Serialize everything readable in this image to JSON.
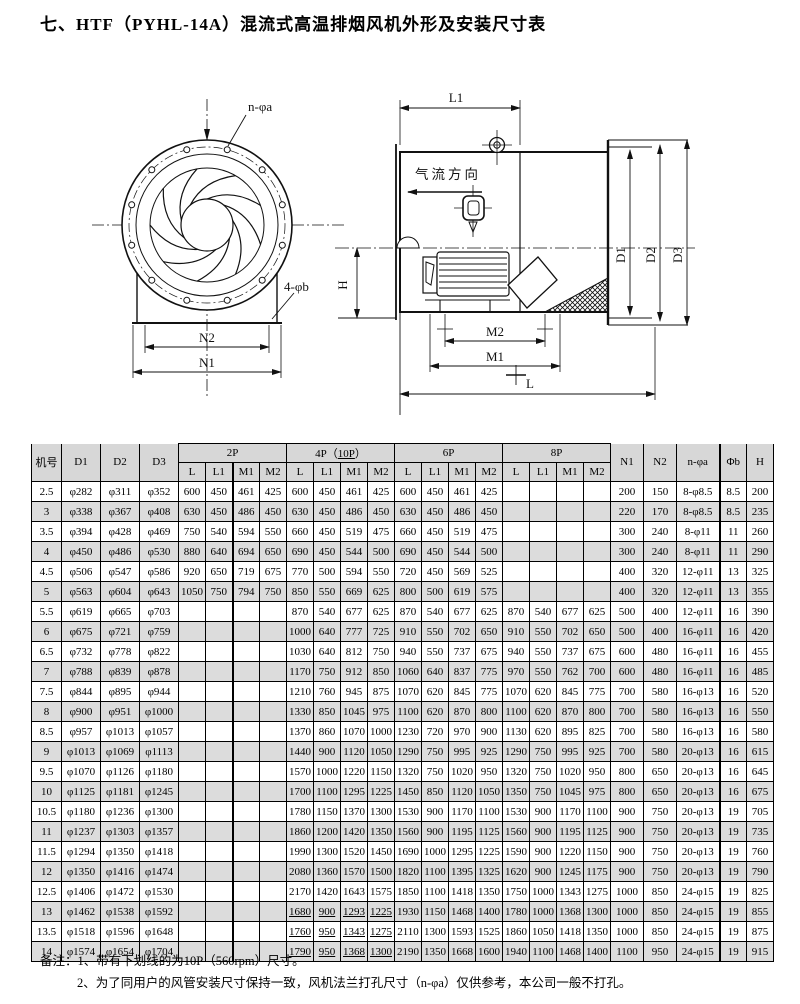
{
  "title": "七、HTF（PYHL-14A）混流式高温排烟风机外形及安装尺寸表",
  "front_view": {
    "label_bolt_holes": "n-φa",
    "label_base_holes": "4-φb",
    "label_n2": "N2",
    "label_n1": "N1"
  },
  "side_view": {
    "label_l1": "L1",
    "label_airflow": "气流方向",
    "label_d1": "D1",
    "label_d2": "D2",
    "label_d3": "D3",
    "label_h": "H",
    "label_m2": "M2",
    "label_m1": "M1",
    "label_l": "L"
  },
  "table": {
    "headers": {
      "jihao": "机号",
      "d1": "D1",
      "d2": "D2",
      "d3": "D3",
      "group_2p": "2P",
      "group_4p_pre": "4P（",
      "group_4p_u": "10P",
      "group_4p_post": "）",
      "group_6p": "6P",
      "group_8p": "8P",
      "sub": [
        "L",
        "L1",
        "M1",
        "M2"
      ],
      "n1": "N1",
      "n2": "N2",
      "na": "n-φa",
      "fb": "Φb",
      "h": "H"
    },
    "rows": [
      {
        "no": "2.5",
        "d1": "φ282",
        "d2": "φ311",
        "d3": "φ352",
        "p2": [
          "600",
          "450",
          "461",
          "425"
        ],
        "p4": [
          "600",
          "450",
          "461",
          "425"
        ],
        "p6": [
          "600",
          "450",
          "461",
          "425"
        ],
        "p8": [
          "",
          "",
          "",
          ""
        ],
        "n1": "200",
        "n2": "150",
        "na": "8-φ8.5",
        "fb": "8.5",
        "h": "200",
        "u4": false
      },
      {
        "no": "3",
        "d1": "φ338",
        "d2": "φ367",
        "d3": "φ408",
        "p2": [
          "630",
          "450",
          "486",
          "450"
        ],
        "p4": [
          "630",
          "450",
          "486",
          "450"
        ],
        "p6": [
          "630",
          "450",
          "486",
          "450"
        ],
        "p8": [
          "",
          "",
          "",
          ""
        ],
        "n1": "220",
        "n2": "170",
        "na": "8-φ8.5",
        "fb": "8.5",
        "h": "235",
        "u4": false
      },
      {
        "no": "3.5",
        "d1": "φ394",
        "d2": "φ428",
        "d3": "φ469",
        "p2": [
          "750",
          "540",
          "594",
          "550"
        ],
        "p4": [
          "660",
          "450",
          "519",
          "475"
        ],
        "p6": [
          "660",
          "450",
          "519",
          "475"
        ],
        "p8": [
          "",
          "",
          "",
          ""
        ],
        "n1": "300",
        "n2": "240",
        "na": "8-φ11",
        "fb": "11",
        "h": "260",
        "u4": false
      },
      {
        "no": "4",
        "d1": "φ450",
        "d2": "φ486",
        "d3": "φ530",
        "p2": [
          "880",
          "640",
          "694",
          "650"
        ],
        "p4": [
          "690",
          "450",
          "544",
          "500"
        ],
        "p6": [
          "690",
          "450",
          "544",
          "500"
        ],
        "p8": [
          "",
          "",
          "",
          ""
        ],
        "n1": "300",
        "n2": "240",
        "na": "8-φ11",
        "fb": "11",
        "h": "290",
        "u4": false
      },
      {
        "no": "4.5",
        "d1": "φ506",
        "d2": "φ547",
        "d3": "φ586",
        "p2": [
          "920",
          "650",
          "719",
          "675"
        ],
        "p4": [
          "770",
          "500",
          "594",
          "550"
        ],
        "p6": [
          "720",
          "450",
          "569",
          "525"
        ],
        "p8": [
          "",
          "",
          "",
          ""
        ],
        "n1": "400",
        "n2": "320",
        "na": "12-φ11",
        "fb": "13",
        "h": "325",
        "u4": false
      },
      {
        "no": "5",
        "d1": "φ563",
        "d2": "φ604",
        "d3": "φ643",
        "p2": [
          "1050",
          "750",
          "794",
          "750"
        ],
        "p4": [
          "850",
          "550",
          "669",
          "625"
        ],
        "p6": [
          "800",
          "500",
          "619",
          "575"
        ],
        "p8": [
          "",
          "",
          "",
          ""
        ],
        "n1": "400",
        "n2": "320",
        "na": "12-φ11",
        "fb": "13",
        "h": "355",
        "u4": false
      },
      {
        "no": "5.5",
        "d1": "φ619",
        "d2": "φ665",
        "d3": "φ703",
        "p2": [
          "",
          "",
          "",
          ""
        ],
        "p4": [
          "870",
          "540",
          "677",
          "625"
        ],
        "p6": [
          "870",
          "540",
          "677",
          "625"
        ],
        "p8": [
          "870",
          "540",
          "677",
          "625"
        ],
        "n1": "500",
        "n2": "400",
        "na": "12-φ11",
        "fb": "16",
        "h": "390",
        "u4": false
      },
      {
        "no": "6",
        "d1": "φ675",
        "d2": "φ721",
        "d3": "φ759",
        "p2": [
          "",
          "",
          "",
          ""
        ],
        "p4": [
          "1000",
          "640",
          "777",
          "725"
        ],
        "p6": [
          "910",
          "550",
          "702",
          "650"
        ],
        "p8": [
          "910",
          "550",
          "702",
          "650"
        ],
        "n1": "500",
        "n2": "400",
        "na": "16-φ11",
        "fb": "16",
        "h": "420",
        "u4": false
      },
      {
        "no": "6.5",
        "d1": "φ732",
        "d2": "φ778",
        "d3": "φ822",
        "p2": [
          "",
          "",
          "",
          ""
        ],
        "p4": [
          "1030",
          "640",
          "812",
          "750"
        ],
        "p6": [
          "940",
          "550",
          "737",
          "675"
        ],
        "p8": [
          "940",
          "550",
          "737",
          "675"
        ],
        "n1": "600",
        "n2": "480",
        "na": "16-φ11",
        "fb": "16",
        "h": "455",
        "u4": false
      },
      {
        "no": "7",
        "d1": "φ788",
        "d2": "φ839",
        "d3": "φ878",
        "p2": [
          "",
          "",
          "",
          ""
        ],
        "p4": [
          "1170",
          "750",
          "912",
          "850"
        ],
        "p6": [
          "1060",
          "640",
          "837",
          "775"
        ],
        "p8": [
          "970",
          "550",
          "762",
          "700"
        ],
        "n1": "600",
        "n2": "480",
        "na": "16-φ11",
        "fb": "16",
        "h": "485",
        "u4": false
      },
      {
        "no": "7.5",
        "d1": "φ844",
        "d2": "φ895",
        "d3": "φ944",
        "p2": [
          "",
          "",
          "",
          ""
        ],
        "p4": [
          "1210",
          "760",
          "945",
          "875"
        ],
        "p6": [
          "1070",
          "620",
          "845",
          "775"
        ],
        "p8": [
          "1070",
          "620",
          "845",
          "775"
        ],
        "n1": "700",
        "n2": "580",
        "na": "16-φ13",
        "fb": "16",
        "h": "520",
        "u4": false
      },
      {
        "no": "8",
        "d1": "φ900",
        "d2": "φ951",
        "d3": "φ1000",
        "p2": [
          "",
          "",
          "",
          ""
        ],
        "p4": [
          "1330",
          "850",
          "1045",
          "975"
        ],
        "p6": [
          "1100",
          "620",
          "870",
          "800"
        ],
        "p8": [
          "1100",
          "620",
          "870",
          "800"
        ],
        "n1": "700",
        "n2": "580",
        "na": "16-φ13",
        "fb": "16",
        "h": "550",
        "u4": false
      },
      {
        "no": "8.5",
        "d1": "φ957",
        "d2": "φ1013",
        "d3": "φ1057",
        "p2": [
          "",
          "",
          "",
          ""
        ],
        "p4": [
          "1370",
          "860",
          "1070",
          "1000"
        ],
        "p6": [
          "1230",
          "720",
          "970",
          "900"
        ],
        "p8": [
          "1130",
          "620",
          "895",
          "825"
        ],
        "n1": "700",
        "n2": "580",
        "na": "16-φ13",
        "fb": "16",
        "h": "580",
        "u4": false
      },
      {
        "no": "9",
        "d1": "φ1013",
        "d2": "φ1069",
        "d3": "φ1113",
        "p2": [
          "",
          "",
          "",
          ""
        ],
        "p4": [
          "1440",
          "900",
          "1120",
          "1050"
        ],
        "p6": [
          "1290",
          "750",
          "995",
          "925"
        ],
        "p8": [
          "1290",
          "750",
          "995",
          "925"
        ],
        "n1": "700",
        "n2": "580",
        "na": "20-φ13",
        "fb": "16",
        "h": "615",
        "u4": false
      },
      {
        "no": "9.5",
        "d1": "φ1070",
        "d2": "φ1126",
        "d3": "φ1180",
        "p2": [
          "",
          "",
          "",
          ""
        ],
        "p4": [
          "1570",
          "1000",
          "1220",
          "1150"
        ],
        "p6": [
          "1320",
          "750",
          "1020",
          "950"
        ],
        "p8": [
          "1320",
          "750",
          "1020",
          "950"
        ],
        "n1": "800",
        "n2": "650",
        "na": "20-φ13",
        "fb": "16",
        "h": "645",
        "u4": false
      },
      {
        "no": "10",
        "d1": "φ1125",
        "d2": "φ1181",
        "d3": "φ1245",
        "p2": [
          "",
          "",
          "",
          ""
        ],
        "p4": [
          "1700",
          "1100",
          "1295",
          "1225"
        ],
        "p6": [
          "1450",
          "850",
          "1120",
          "1050"
        ],
        "p8": [
          "1350",
          "750",
          "1045",
          "975"
        ],
        "n1": "800",
        "n2": "650",
        "na": "20-φ13",
        "fb": "16",
        "h": "675",
        "u4": false
      },
      {
        "no": "10.5",
        "d1": "φ1180",
        "d2": "φ1236",
        "d3": "φ1300",
        "p2": [
          "",
          "",
          "",
          ""
        ],
        "p4": [
          "1780",
          "1150",
          "1370",
          "1300"
        ],
        "p6": [
          "1530",
          "900",
          "1170",
          "1100"
        ],
        "p8": [
          "1530",
          "900",
          "1170",
          "1100"
        ],
        "n1": "900",
        "n2": "750",
        "na": "20-φ13",
        "fb": "19",
        "h": "705",
        "u4": false
      },
      {
        "no": "11",
        "d1": "φ1237",
        "d2": "φ1303",
        "d3": "φ1357",
        "p2": [
          "",
          "",
          "",
          ""
        ],
        "p4": [
          "1860",
          "1200",
          "1420",
          "1350"
        ],
        "p6": [
          "1560",
          "900",
          "1195",
          "1125"
        ],
        "p8": [
          "1560",
          "900",
          "1195",
          "1125"
        ],
        "n1": "900",
        "n2": "750",
        "na": "20-φ13",
        "fb": "19",
        "h": "735",
        "u4": false
      },
      {
        "no": "11.5",
        "d1": "φ1294",
        "d2": "φ1350",
        "d3": "φ1418",
        "p2": [
          "",
          "",
          "",
          ""
        ],
        "p4": [
          "1990",
          "1300",
          "1520",
          "1450"
        ],
        "p6": [
          "1690",
          "1000",
          "1295",
          "1225"
        ],
        "p8": [
          "1590",
          "900",
          "1220",
          "1150"
        ],
        "n1": "900",
        "n2": "750",
        "na": "20-φ13",
        "fb": "19",
        "h": "760",
        "u4": false
      },
      {
        "no": "12",
        "d1": "φ1350",
        "d2": "φ1416",
        "d3": "φ1474",
        "p2": [
          "",
          "",
          "",
          ""
        ],
        "p4": [
          "2080",
          "1360",
          "1570",
          "1500"
        ],
        "p6": [
          "1820",
          "1100",
          "1395",
          "1325"
        ],
        "p8": [
          "1620",
          "900",
          "1245",
          "1175"
        ],
        "n1": "900",
        "n2": "750",
        "na": "20-φ13",
        "fb": "19",
        "h": "790",
        "u4": false
      },
      {
        "no": "12.5",
        "d1": "φ1406",
        "d2": "φ1472",
        "d3": "φ1530",
        "p2": [
          "",
          "",
          "",
          ""
        ],
        "p4": [
          "2170",
          "1420",
          "1643",
          "1575"
        ],
        "p6": [
          "1850",
          "1100",
          "1418",
          "1350"
        ],
        "p8": [
          "1750",
          "1000",
          "1343",
          "1275"
        ],
        "n1": "1000",
        "n2": "850",
        "na": "24-φ15",
        "fb": "19",
        "h": "825",
        "u4": false
      },
      {
        "no": "13",
        "d1": "φ1462",
        "d2": "φ1538",
        "d3": "φ1592",
        "p2": [
          "",
          "",
          "",
          ""
        ],
        "p4": [
          "1680",
          "900",
          "1293",
          "1225"
        ],
        "p6": [
          "1930",
          "1150",
          "1468",
          "1400"
        ],
        "p8": [
          "1780",
          "1000",
          "1368",
          "1300"
        ],
        "n1": "1000",
        "n2": "850",
        "na": "24-φ15",
        "fb": "19",
        "h": "855",
        "u4": true
      },
      {
        "no": "13.5",
        "d1": "φ1518",
        "d2": "φ1596",
        "d3": "φ1648",
        "p2": [
          "",
          "",
          "",
          ""
        ],
        "p4": [
          "1760",
          "950",
          "1343",
          "1275"
        ],
        "p6": [
          "2110",
          "1300",
          "1593",
          "1525"
        ],
        "p8": [
          "1860",
          "1050",
          "1418",
          "1350"
        ],
        "n1": "1000",
        "n2": "850",
        "na": "24-φ15",
        "fb": "19",
        "h": "875",
        "u4": true
      },
      {
        "no": "14",
        "d1": "φ1574",
        "d2": "φ1654",
        "d3": "φ1704",
        "p2": [
          "",
          "",
          "",
          ""
        ],
        "p4": [
          "1790",
          "950",
          "1368",
          "1300"
        ],
        "p6": [
          "2190",
          "1350",
          "1668",
          "1600"
        ],
        "p8": [
          "1940",
          "1100",
          "1468",
          "1400"
        ],
        "n1": "1100",
        "n2": "950",
        "na": "24-φ15",
        "fb": "19",
        "h": "915",
        "u4": true
      }
    ]
  },
  "notes": {
    "prefix": "备注：",
    "line1": "1、带有下划线的为10P（560rpm）尺寸。",
    "line2": "2、为了同用户的风管安装尺寸保持一致，风机法兰打孔尺寸（n-φa）仅供参考，本公司一般不打孔。"
  }
}
